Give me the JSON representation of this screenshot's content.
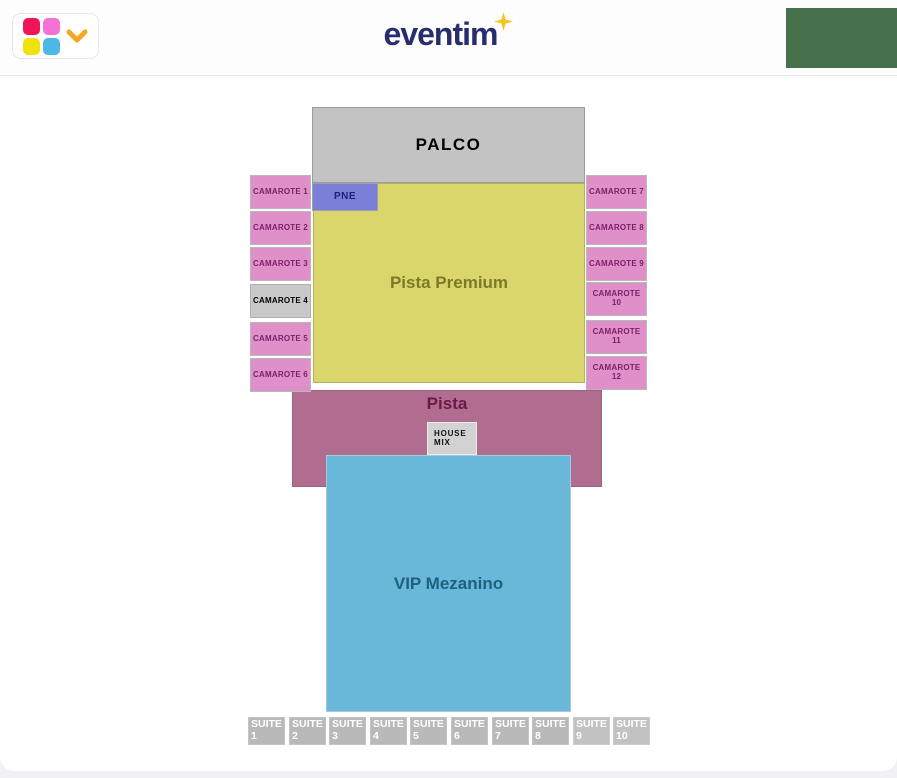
{
  "header": {
    "logo": {
      "text": "eventim",
      "text_color": "#282d6e",
      "star_color": "#f7c41f"
    },
    "map_picker": {
      "squares": [
        {
          "name": "crimson",
          "color": "#f0145a"
        },
        {
          "name": "pink",
          "color": "#f472d4"
        },
        {
          "name": "yellow",
          "color": "#f0e20c"
        },
        {
          "name": "blue",
          "color": "#4db7e6"
        }
      ],
      "chevron_color": "#f5a623"
    },
    "green_panel_color": "#47704d"
  },
  "map": {
    "sections": [
      {
        "id": "palco",
        "label": "PALCO",
        "x": 312,
        "y": 107,
        "w": 273,
        "h": 76,
        "fill": "#c3c3c3",
        "border": "#9d9d9d",
        "text_color": "#000000",
        "font_size": 17,
        "letter_spacing": 1.5,
        "clickable": false
      },
      {
        "id": "pista-premium",
        "label": "Pista Premium",
        "x": 313,
        "y": 183,
        "w": 272,
        "h": 200,
        "fill": "#dbd66b",
        "border": "#b5b05a",
        "text_color": "#7b7b27",
        "font_size": 17,
        "clickable": true
      },
      {
        "id": "pne",
        "label": "PNE",
        "x": 312,
        "y": 183,
        "w": 66,
        "h": 28,
        "fill": "#7b7fd7",
        "border": "#9aa0b2",
        "text_color": "#1f2180",
        "font_size": 10,
        "letter_spacing": 0.5,
        "clickable": true
      },
      {
        "id": "pista",
        "label": "Pista",
        "x": 292,
        "y": 390,
        "w": 310,
        "h": 97,
        "fill": "#b16d90",
        "border": "#a06080",
        "text_color": "#6b1946",
        "font_size": 17,
        "label_pos": "top",
        "pad_top": 3,
        "clickable": true
      },
      {
        "id": "camarote-1",
        "label": "CAMAROTE 1",
        "x": 250,
        "y": 175,
        "w": 61,
        "h": 34,
        "fill": "#df90c8",
        "border": "#b8b8b8",
        "text_color": "#7d2069",
        "font_size": 8,
        "letter_spacing": 0.2,
        "clickable": true
      },
      {
        "id": "camarote-2",
        "label": "CAMAROTE 2",
        "x": 250,
        "y": 211,
        "w": 61,
        "h": 34,
        "fill": "#df90c8",
        "border": "#b8b8b8",
        "text_color": "#7d2069",
        "font_size": 8,
        "letter_spacing": 0.2,
        "clickable": true
      },
      {
        "id": "camarote-3",
        "label": "CAMAROTE 3",
        "x": 250,
        "y": 247,
        "w": 61,
        "h": 34,
        "fill": "#df90c8",
        "border": "#b8b8b8",
        "text_color": "#7d2069",
        "font_size": 8,
        "letter_spacing": 0.2,
        "clickable": true
      },
      {
        "id": "camarote-4",
        "label": "CAMAROTE 4",
        "x": 250,
        "y": 284,
        "w": 61,
        "h": 34,
        "fill": "#c9c9c9",
        "border": "#b0b0b0",
        "text_color": "#000000",
        "font_size": 8,
        "letter_spacing": 0.2,
        "clickable": false
      },
      {
        "id": "camarote-5",
        "label": "CAMAROTE 5",
        "x": 250,
        "y": 322,
        "w": 61,
        "h": 34,
        "fill": "#df90c8",
        "border": "#b8b8b8",
        "text_color": "#7d2069",
        "font_size": 8,
        "letter_spacing": 0.2,
        "clickable": true
      },
      {
        "id": "camarote-6",
        "label": "CAMAROTE 6",
        "x": 250,
        "y": 358,
        "w": 61,
        "h": 34,
        "fill": "#df90c8",
        "border": "#b8b8b8",
        "text_color": "#7d2069",
        "font_size": 8,
        "letter_spacing": 0.2,
        "clickable": true
      },
      {
        "id": "camarote-7",
        "label": "CAMAROTE 7",
        "x": 586,
        "y": 175,
        "w": 61,
        "h": 34,
        "fill": "#df90c8",
        "border": "#b8b8b8",
        "text_color": "#7d2069",
        "font_size": 8,
        "letter_spacing": 0.2,
        "clickable": true
      },
      {
        "id": "camarote-8",
        "label": "CAMAROTE 8",
        "x": 586,
        "y": 211,
        "w": 61,
        "h": 34,
        "fill": "#df90c8",
        "border": "#b8b8b8",
        "text_color": "#7d2069",
        "font_size": 8,
        "letter_spacing": 0.2,
        "clickable": true
      },
      {
        "id": "camarote-9",
        "label": "CAMAROTE 9",
        "x": 586,
        "y": 247,
        "w": 61,
        "h": 34,
        "fill": "#df90c8",
        "border": "#b8b8b8",
        "text_color": "#7d2069",
        "font_size": 8,
        "letter_spacing": 0.2,
        "clickable": true
      },
      {
        "id": "camarote-10",
        "label": "CAMAROTE 10",
        "x": 586,
        "y": 282,
        "w": 61,
        "h": 34,
        "fill": "#df90c8",
        "border": "#b8b8b8",
        "text_color": "#7d2069",
        "font_size": 8,
        "letter_spacing": 0.2,
        "clickable": true
      },
      {
        "id": "camarote-11",
        "label": "CAMAROTE 11",
        "x": 586,
        "y": 320,
        "w": 61,
        "h": 34,
        "fill": "#df90c8",
        "border": "#b8b8b8",
        "text_color": "#7d2069",
        "font_size": 8,
        "letter_spacing": 0.2,
        "clickable": true
      },
      {
        "id": "camarote-12",
        "label": "CAMAROTE 12",
        "x": 586,
        "y": 356,
        "w": 61,
        "h": 34,
        "fill": "#df90c8",
        "border": "#b8b8b8",
        "text_color": "#7d2069",
        "font_size": 8,
        "letter_spacing": 0.2,
        "clickable": true
      },
      {
        "id": "house-mix",
        "label": "HOUSE\nMIX",
        "x": 427,
        "y": 422,
        "w": 50,
        "h": 33,
        "fill": "#d2d2d2",
        "border": "#ececec",
        "text_color": "#111111",
        "font_size": 8,
        "letter_spacing": 0.8,
        "text_align": "left",
        "pad_left": 6,
        "clickable": false
      },
      {
        "id": "vip-mezanino",
        "label": "VIP Mezanino",
        "x": 326,
        "y": 455,
        "w": 245,
        "h": 257,
        "fill": "#69b7d9",
        "border": "#a6ccdc",
        "text_color": "#1c617f",
        "font_size": 17,
        "clickable": true
      },
      {
        "id": "suite-1",
        "label": "SUITE\n1",
        "x": 248,
        "y": 717,
        "w": 37,
        "h": 28,
        "fill": "#b9b9b9",
        "border": "#c4c4c4",
        "text_color": "#ffffff",
        "font_size": 10.5,
        "text_align": "left",
        "label_pos": "top",
        "pad_left": 2,
        "pad_top": 1,
        "clickable": false
      },
      {
        "id": "suite-2",
        "label": "SUITE\n2",
        "x": 289,
        "y": 717,
        "w": 37,
        "h": 28,
        "fill": "#b9b9b9",
        "border": "#c4c4c4",
        "text_color": "#ffffff",
        "font_size": 10.5,
        "text_align": "left",
        "label_pos": "top",
        "pad_left": 2,
        "pad_top": 1,
        "clickable": false
      },
      {
        "id": "suite-3",
        "label": "SUITE\n3",
        "x": 329,
        "y": 717,
        "w": 37,
        "h": 28,
        "fill": "#b9b9b9",
        "border": "#c4c4c4",
        "text_color": "#ffffff",
        "font_size": 10.5,
        "text_align": "left",
        "label_pos": "top",
        "pad_left": 2,
        "pad_top": 1,
        "clickable": false
      },
      {
        "id": "suite-4",
        "label": "SUITE\n4",
        "x": 370,
        "y": 717,
        "w": 37,
        "h": 28,
        "fill": "#b9b9b9",
        "border": "#c4c4c4",
        "text_color": "#ffffff",
        "font_size": 10.5,
        "text_align": "left",
        "label_pos": "top",
        "pad_left": 2,
        "pad_top": 1,
        "clickable": false
      },
      {
        "id": "suite-5",
        "label": "SUITE\n5",
        "x": 410,
        "y": 717,
        "w": 37,
        "h": 28,
        "fill": "#b9b9b9",
        "border": "#c4c4c4",
        "text_color": "#ffffff",
        "font_size": 10.5,
        "text_align": "left",
        "label_pos": "top",
        "pad_left": 2,
        "pad_top": 1,
        "clickable": false
      },
      {
        "id": "suite-6",
        "label": "SUITE\n6",
        "x": 451,
        "y": 717,
        "w": 37,
        "h": 28,
        "fill": "#b9b9b9",
        "border": "#c4c4c4",
        "text_color": "#ffffff",
        "font_size": 10.5,
        "text_align": "left",
        "label_pos": "top",
        "pad_left": 2,
        "pad_top": 1,
        "clickable": false
      },
      {
        "id": "suite-7",
        "label": "SUITE\n7",
        "x": 492,
        "y": 717,
        "w": 37,
        "h": 28,
        "fill": "#b9b9b9",
        "border": "#c4c4c4",
        "text_color": "#ffffff",
        "font_size": 10.5,
        "text_align": "left",
        "label_pos": "top",
        "pad_left": 2,
        "pad_top": 1,
        "clickable": false
      },
      {
        "id": "suite-8",
        "label": "SUITE\n8",
        "x": 532,
        "y": 717,
        "w": 37,
        "h": 28,
        "fill": "#b9b9b9",
        "border": "#c4c4c4",
        "text_color": "#ffffff",
        "font_size": 10.5,
        "text_align": "left",
        "label_pos": "top",
        "pad_left": 2,
        "pad_top": 1,
        "clickable": false
      },
      {
        "id": "suite-9",
        "label": "SUITE\n9",
        "x": 573,
        "y": 717,
        "w": 37,
        "h": 28,
        "fill": "#c2c2c2",
        "border": "#cccccc",
        "text_color": "#ffffff",
        "font_size": 10.5,
        "text_align": "left",
        "label_pos": "top",
        "pad_left": 2,
        "pad_top": 1,
        "clickable": false
      },
      {
        "id": "suite-10",
        "label": "SUITE\n10",
        "x": 613,
        "y": 717,
        "w": 37,
        "h": 28,
        "fill": "#c2c2c2",
        "border": "#cccccc",
        "text_color": "#ffffff",
        "font_size": 10.5,
        "text_align": "left",
        "label_pos": "top",
        "pad_left": 2,
        "pad_top": 1,
        "clickable": false
      }
    ]
  }
}
